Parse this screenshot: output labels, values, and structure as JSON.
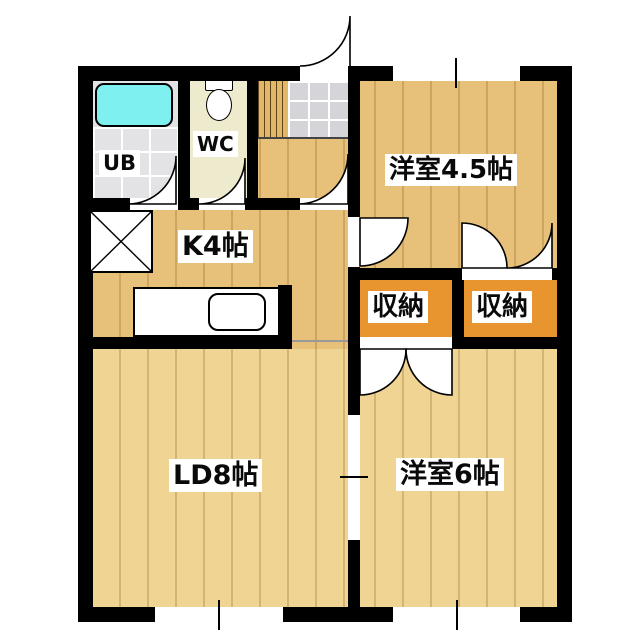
{
  "colors": {
    "wall": "#000000",
    "floor_wood": "#e7c07a",
    "floor_wood_light": "#f0d494",
    "floor_storage": "#e9952f",
    "bathtub": "#7df0ef",
    "floor_ub": "#e3e3e5",
    "floor_wc": "#edeacd",
    "floor_tile": "#d5d5d9",
    "floor_steps": "#e2b766"
  },
  "rooms": {
    "unit_bath": {
      "label": "UB"
    },
    "toilet": {
      "label": "WC"
    },
    "kitchen": {
      "label": "K4帖"
    },
    "living_dining": {
      "label": "LD8帖"
    },
    "western_room_45": {
      "label": "洋室4.5帖"
    },
    "western_room_6": {
      "label": "洋室6帖"
    },
    "storage_left": {
      "label": "収納"
    },
    "storage_right": {
      "label": "収納"
    }
  }
}
